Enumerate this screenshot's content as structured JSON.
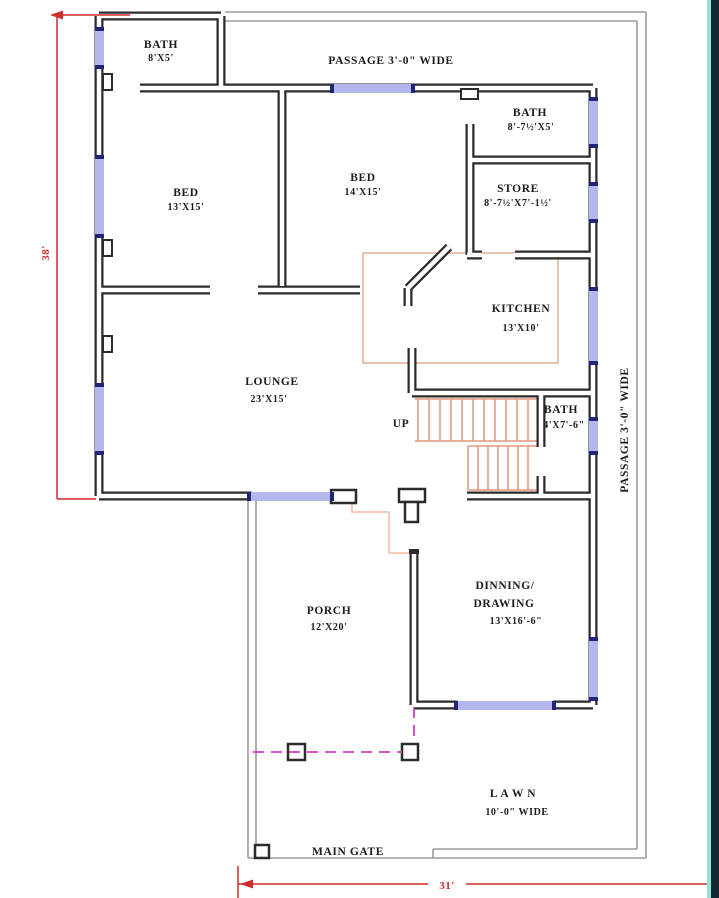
{
  "colors": {
    "wall": "#2b2b2b",
    "plot_boundary": "#9b9b9b",
    "window_glass": "#b3b7ee",
    "window_frame": "#23237a",
    "stairs": "#e2957f",
    "door_path": "#f2bca6",
    "gate_dashed_line": "#cf3ec2",
    "dimension_red": "#cf2c2c",
    "edge_strip": "#16262e",
    "edge_accent": "#8fe4da"
  },
  "rooms": {
    "bath_top_left": {
      "name": "BATH",
      "size": "8'X5'"
    },
    "bath_top_right": {
      "name": "BATH",
      "size": "8'-7½'X5'"
    },
    "bed_left": {
      "name": "BED",
      "size": "13'X15'"
    },
    "bed_middle": {
      "name": "BED",
      "size": "14'X15'"
    },
    "store": {
      "name": "STORE",
      "size": "8'-7½'X7'-1½'"
    },
    "kitchen": {
      "name": "KITCHEN",
      "size": "13'X10'"
    },
    "lounge": {
      "name": "LOUNGE",
      "size": "23'X15'"
    },
    "bath_stairs": {
      "name": "BATH",
      "size": "4'X7'-6\""
    },
    "dinning_drawing": {
      "line1": "DINNING/",
      "line2": "DRAWING",
      "size": "13'X16'-6\""
    },
    "porch": {
      "name": "PORCH",
      "size": "12'X20'"
    },
    "lawn": {
      "name": "L A W N",
      "size": "10'-0\" WIDE"
    }
  },
  "labels": {
    "passage_top": "PASSAGE 3'-0\" WIDE",
    "passage_right": "PASSAGE 3'-0\" WIDE",
    "up": "UP",
    "main_gate": "MAIN GATE"
  },
  "dimensions": {
    "plot_height": "38'",
    "plot_width": "31'"
  }
}
